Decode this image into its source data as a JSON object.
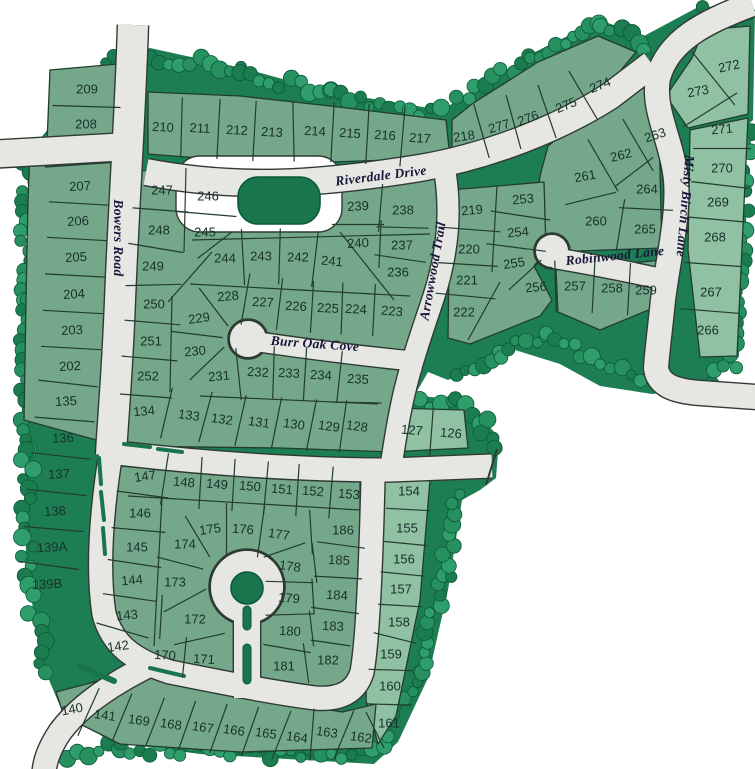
{
  "map_title": "residential subdivision plat map",
  "colors": {
    "background": "#ffffff",
    "lot": "#75a88b",
    "lot_light": "#90c1a3",
    "greenbelt": "#1e7e53",
    "tree_light": "#2f9e6c",
    "tree_mid": "#26905f",
    "tree_dark": "#1b7c50",
    "tree_outline": "#0b5a39",
    "water_feature": "#19754c",
    "road": "#e6e6e2",
    "road_edge": "#2f3a33",
    "parcel_line": "#223c30",
    "lot_text": "#17312a",
    "street_text": "#16163a"
  },
  "streets": [
    {
      "label": "Riverdale Drive",
      "x": 381,
      "y": 176,
      "r": -7
    },
    {
      "label": "Bowers Road",
      "x": 118,
      "y": 238,
      "r": 90
    },
    {
      "label": "Arrowwood Trail",
      "x": 433,
      "y": 271,
      "r": -80
    },
    {
      "label": "Misty Birch Lane",
      "x": 685,
      "y": 206,
      "r": 95
    },
    {
      "label": "Robinwood Lane",
      "x": 615,
      "y": 256,
      "r": -6
    },
    {
      "label": "Burr Oak Cove",
      "x": 315,
      "y": 344,
      "r": 4
    }
  ],
  "lots": [
    [
      "209",
      87,
      89,
      0
    ],
    [
      "208",
      86,
      124,
      0
    ],
    [
      "210",
      163,
      127,
      3
    ],
    [
      "211",
      200,
      128,
      3
    ],
    [
      "212",
      237,
      130,
      3
    ],
    [
      "213",
      272,
      132,
      3
    ],
    [
      "214",
      315,
      131,
      3
    ],
    [
      "215",
      350,
      133,
      4
    ],
    [
      "216",
      385,
      135,
      4
    ],
    [
      "217",
      420,
      138,
      4
    ],
    [
      "218",
      464,
      136,
      -8
    ],
    [
      "277",
      499,
      126,
      -16
    ],
    [
      "276",
      528,
      118,
      -20
    ],
    [
      "275",
      566,
      105,
      -22
    ],
    [
      "274",
      600,
      85,
      -22
    ],
    [
      "272",
      729,
      66,
      -12
    ],
    [
      "273",
      698,
      91,
      -10
    ],
    [
      "271",
      722,
      129,
      -5
    ],
    [
      "270",
      722,
      168,
      0
    ],
    [
      "269",
      718,
      202,
      0
    ],
    [
      "268",
      715,
      237,
      0
    ],
    [
      "267",
      711,
      292,
      0
    ],
    [
      "266",
      708,
      330,
      0
    ],
    [
      "263",
      655,
      135,
      -18
    ],
    [
      "262",
      621,
      155,
      -14
    ],
    [
      "261",
      585,
      176,
      -10
    ],
    [
      "264",
      647,
      189,
      0
    ],
    [
      "260",
      596,
      221,
      0
    ],
    [
      "265",
      645,
      229,
      0
    ],
    [
      "253",
      523,
      199,
      -5
    ],
    [
      "254",
      518,
      232,
      -5
    ],
    [
      "255",
      514,
      263,
      -8
    ],
    [
      "256",
      536,
      287,
      -5
    ],
    [
      "257",
      575,
      286,
      0
    ],
    [
      "258",
      612,
      288,
      0
    ],
    [
      "259",
      646,
      290,
      0
    ],
    [
      "219",
      472,
      210,
      -5
    ],
    [
      "220",
      469,
      249,
      0
    ],
    [
      "221",
      467,
      280,
      0
    ],
    [
      "222",
      464,
      312,
      0
    ],
    [
      "247",
      162,
      190,
      0
    ],
    [
      "246",
      208,
      196,
      0
    ],
    [
      "248",
      159,
      230,
      0
    ],
    [
      "245",
      205,
      232,
      0
    ],
    [
      "249",
      153,
      266,
      0
    ],
    [
      "250",
      154,
      304,
      0
    ],
    [
      "251",
      151,
      341,
      0
    ],
    [
      "252",
      148,
      376,
      0
    ],
    [
      "244",
      225,
      258,
      0
    ],
    [
      "243",
      261,
      256,
      0
    ],
    [
      "242",
      298,
      257,
      0
    ],
    [
      "241",
      332,
      261,
      5
    ],
    [
      "239",
      358,
      206,
      -3
    ],
    [
      "238",
      403,
      210,
      0
    ],
    [
      "240",
      358,
      243,
      -3
    ],
    [
      "237",
      402,
      245,
      0
    ],
    [
      "236",
      398,
      272,
      0
    ],
    [
      "228",
      228,
      296,
      -5
    ],
    [
      "227",
      263,
      302,
      3
    ],
    [
      "226",
      296,
      306,
      3
    ],
    [
      "225",
      328,
      308,
      3
    ],
    [
      "224",
      356,
      309,
      3
    ],
    [
      "223",
      392,
      311,
      5
    ],
    [
      "229",
      199,
      318,
      -8
    ],
    [
      "230",
      195,
      351,
      -5
    ],
    [
      "231",
      219,
      376,
      -5
    ],
    [
      "232",
      258,
      372,
      3
    ],
    [
      "233",
      289,
      373,
      3
    ],
    [
      "234",
      321,
      375,
      3
    ],
    [
      "235",
      358,
      379,
      3
    ],
    [
      "207",
      80,
      186,
      -3
    ],
    [
      "206",
      78,
      221,
      -3
    ],
    [
      "205",
      76,
      257,
      -3
    ],
    [
      "204",
      74,
      294,
      -3
    ],
    [
      "203",
      72,
      330,
      -3
    ],
    [
      "202",
      70,
      366,
      -3
    ],
    [
      "135",
      66,
      401,
      -3
    ],
    [
      "136",
      63,
      438,
      -3
    ],
    [
      "137",
      59,
      474,
      -3
    ],
    [
      "138",
      55,
      511,
      -3
    ],
    [
      "139A",
      52,
      547,
      -3
    ],
    [
      "139B",
      47,
      584,
      -3
    ],
    [
      "134",
      144,
      411,
      -5
    ],
    [
      "133",
      189,
      415,
      8
    ],
    [
      "132",
      222,
      419,
      8
    ],
    [
      "131",
      259,
      422,
      8
    ],
    [
      "130",
      294,
      424,
      8
    ],
    [
      "129",
      329,
      426,
      8
    ],
    [
      "128",
      357,
      426,
      8
    ],
    [
      "127",
      412,
      430,
      5
    ],
    [
      "126",
      451,
      433,
      5
    ],
    [
      "147",
      145,
      476,
      -8
    ],
    [
      "148",
      184,
      482,
      5
    ],
    [
      "149",
      217,
      484,
      5
    ],
    [
      "150",
      250,
      486,
      5
    ],
    [
      "151",
      282,
      489,
      5
    ],
    [
      "152",
      313,
      491,
      5
    ],
    [
      "153",
      349,
      494,
      5
    ],
    [
      "146",
      140,
      513,
      0
    ],
    [
      "145",
      137,
      547,
      0
    ],
    [
      "144",
      132,
      580,
      -5
    ],
    [
      "143",
      127,
      615,
      -5
    ],
    [
      "142",
      118,
      646,
      -8
    ],
    [
      "175",
      210,
      529,
      -8
    ],
    [
      "176",
      243,
      529,
      5
    ],
    [
      "177",
      279,
      534,
      8
    ],
    [
      "174",
      185,
      544,
      0
    ],
    [
      "173",
      175,
      582,
      0
    ],
    [
      "172",
      195,
      619,
      0
    ],
    [
      "170",
      165,
      655,
      3
    ],
    [
      "171",
      204,
      659,
      3
    ],
    [
      "178",
      290,
      566,
      8
    ],
    [
      "179",
      289,
      598,
      5
    ],
    [
      "180",
      290,
      631,
      3
    ],
    [
      "181",
      284,
      666,
      0
    ],
    [
      "182",
      328,
      660,
      0
    ],
    [
      "186",
      343,
      530,
      0
    ],
    [
      "185",
      339,
      560,
      3
    ],
    [
      "184",
      337,
      595,
      3
    ],
    [
      "183",
      333,
      626,
      3
    ],
    [
      "154",
      409,
      491,
      0
    ],
    [
      "155",
      407,
      528,
      0
    ],
    [
      "156",
      404,
      559,
      0
    ],
    [
      "157",
      401,
      589,
      0
    ],
    [
      "158",
      399,
      622,
      0
    ],
    [
      "159",
      391,
      654,
      0
    ],
    [
      "160",
      390,
      686,
      0
    ],
    [
      "161",
      389,
      723,
      0
    ],
    [
      "162",
      361,
      737,
      8
    ],
    [
      "163",
      327,
      732,
      8
    ],
    [
      "164",
      297,
      737,
      8
    ],
    [
      "165",
      266,
      733,
      8
    ],
    [
      "166",
      234,
      730,
      8
    ],
    [
      "167",
      203,
      727,
      8
    ],
    [
      "168",
      171,
      724,
      8
    ],
    [
      "169",
      139,
      720,
      8
    ],
    [
      "141",
      105,
      715,
      8
    ],
    [
      "140",
      72,
      709,
      -10
    ]
  ]
}
